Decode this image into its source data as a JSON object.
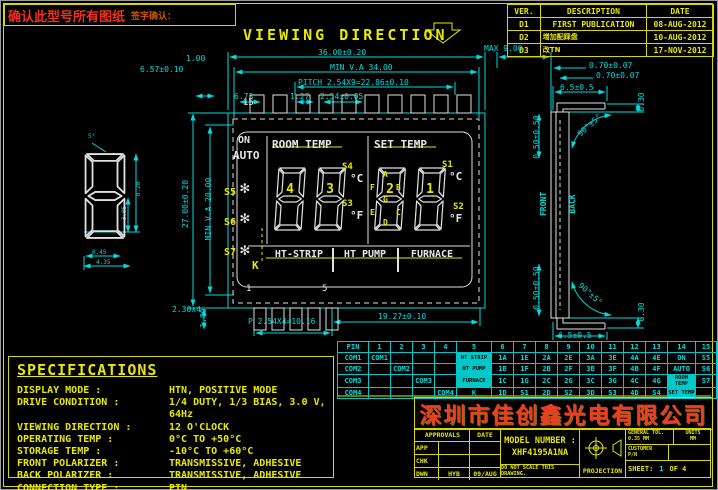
{
  "confirm_box": {
    "text": "确认此型号所有图纸",
    "sign_text": "签字确认："
  },
  "rev": {
    "headers": [
      "VER.",
      "DESCRIPTION",
      "DATE"
    ],
    "rows": [
      [
        "D1",
        "FIRST PUBLICATION",
        "08-AUG-2012"
      ],
      [
        "D2",
        "增加配踩盘",
        "10-AUG-2012"
      ],
      [
        "D3",
        "改TN",
        "17-NOV-2012"
      ]
    ]
  },
  "viewing_direction": "VIEWING  DIRECTION",
  "dims": {
    "w_total": "36.00±0.20",
    "w_va": "MIN V.A 34.00",
    "pitch_top": "PITCH 2.54X9=22.86±0.10",
    "p127": "1.27",
    "p254": "2.54±0.05",
    "p673": "6.73",
    "t100": "1.00",
    "t657": "6.57±0.10",
    "h_total": "27.00±0.20",
    "h_va": "MIN V.A 20.00",
    "b100": "1.00",
    "b230": "2.30x4",
    "pitch_bot": "P 2.54X4=10.16",
    "b1927": "19.27±0.10",
    "max_d": "MAX 9.00",
    "s070a": "0.70±0.07",
    "s070b": "0.70±0.07",
    "s65t": "6.5±0.5",
    "s65b": "6.5±0.5",
    "s030t": "0.30",
    "s030b": "0.30",
    "angt": "90°±5°",
    "angb": "90°±5°",
    "s050t": "0.50±0.50",
    "s050b": "0.50±0.50",
    "front": "FRONT",
    "back": "BACK",
    "pin15": "15",
    "pin1": "1",
    "pin5": "5",
    "det_ang": "5°",
    "det_045": "0.45",
    "det_435": "4.35",
    "det_820": "8.20",
    "det_305": "3.05"
  },
  "lcd": {
    "on": "ON",
    "auto": "AUTO",
    "room": "ROOM TEMP",
    "set": "SET TEMP",
    "boxes": [
      "HT-STRIP",
      "HT PUMP",
      "FURNACE"
    ],
    "k": "K",
    "digits": [
      "4",
      "3",
      "2",
      "1"
    ],
    "s1": "S1",
    "s2": "S2",
    "s3": "S3",
    "s4": "S4",
    "s5": "S5",
    "s6": "S6",
    "s7": "S7",
    "degc": "°C",
    "degf": "°F",
    "snowflake_icon": "✻",
    "seg": {
      "a": "A",
      "b": "B",
      "c": "C",
      "d": "D",
      "e": "E",
      "f": "F",
      "g": "G"
    }
  },
  "pin_table": {
    "headers": [
      "PIN",
      "1",
      "2",
      "3",
      "4",
      "5",
      "6",
      "7",
      "8",
      "9",
      "10",
      "11",
      "12",
      "13",
      "14",
      "15"
    ],
    "rows": [
      [
        "COM1",
        "COM1",
        "",
        "",
        "",
        "HT STRIP",
        "1A",
        "1E",
        "2A",
        "2E",
        "3A",
        "3E",
        "4A",
        "4E",
        "ON",
        "S5"
      ],
      [
        "COM2",
        "",
        "COM2",
        "",
        "",
        "HT PUMP",
        "1B",
        "1F",
        "2B",
        "2F",
        "3B",
        "3F",
        "4B",
        "4F",
        "AUTO",
        "S6"
      ],
      [
        "COM3",
        "",
        "",
        "COM3",
        "",
        "FURNACE",
        "1C",
        "1G",
        "2C",
        "2G",
        "3C",
        "3G",
        "4C",
        "4G",
        "ROOM TEMP",
        "S7"
      ],
      [
        "COM4",
        "",
        "",
        "",
        "COM4",
        "K",
        "1D",
        "S1",
        "2D",
        "S2",
        "3D",
        "S3",
        "4D",
        "S4",
        "SET TEMP",
        ""
      ]
    ],
    "highlights": [
      [
        0,
        5
      ],
      [
        1,
        5
      ],
      [
        2,
        5
      ],
      [
        2,
        14
      ],
      [
        3,
        14
      ]
    ]
  },
  "specs": {
    "title": "SPECIFICATIONS",
    "rows": [
      {
        "label": "DISPLAY MODE :",
        "value": "HTN, POSITIVE MODE"
      },
      {
        "label": "DRIVE CONDITION :",
        "value": "1/4 DUTY, 1/3 BIAS, 3.0 V, 64Hz"
      },
      {
        "label": "VIEWING DIRECTION :",
        "value": "12 O'CLOCK"
      },
      {
        "label": "OPERATING TEMP :",
        "value": "0°C TO +50°C"
      },
      {
        "label": "STORAGE TEMP :",
        "value": "-10°C TO +60°C"
      },
      {
        "label": "FRONT POLARIZER :",
        "value": "TRANSMISSIVE, ADHESIVE"
      },
      {
        "label": "BACK POLARIZER :",
        "value": "TRANSMISSIVE, ADHESIVE"
      },
      {
        "label": "CONNECTION TYPE :",
        "value": "PIN"
      }
    ]
  },
  "title_block": {
    "company": "深圳市佳创鑫光电有限公司",
    "approvals_header": "APPROVALS",
    "date_header": "DATE",
    "rows": [
      {
        "label": "APP",
        "name": "",
        "date": ""
      },
      {
        "label": "CHK",
        "name": "",
        "date": ""
      },
      {
        "label": "DWN",
        "name": "HYB",
        "date": "09/AUG"
      }
    ],
    "model_label": "MODEL NUMBER :",
    "model_number": "XHF4195A1NA",
    "note": "DO NOT SCALE THIS DRAWING.",
    "projection_label": "PROJECTION",
    "general_tol_label": "GENERAL TOL.",
    "general_tol": "0.35 MM",
    "units_label": "UNITS",
    "units": "MM",
    "customer_label": "CUSTOMER",
    "pn_label": "P/N",
    "sheet_label": "SHEET:",
    "sheet_num": "1",
    "sheet_of": "OF 4"
  }
}
